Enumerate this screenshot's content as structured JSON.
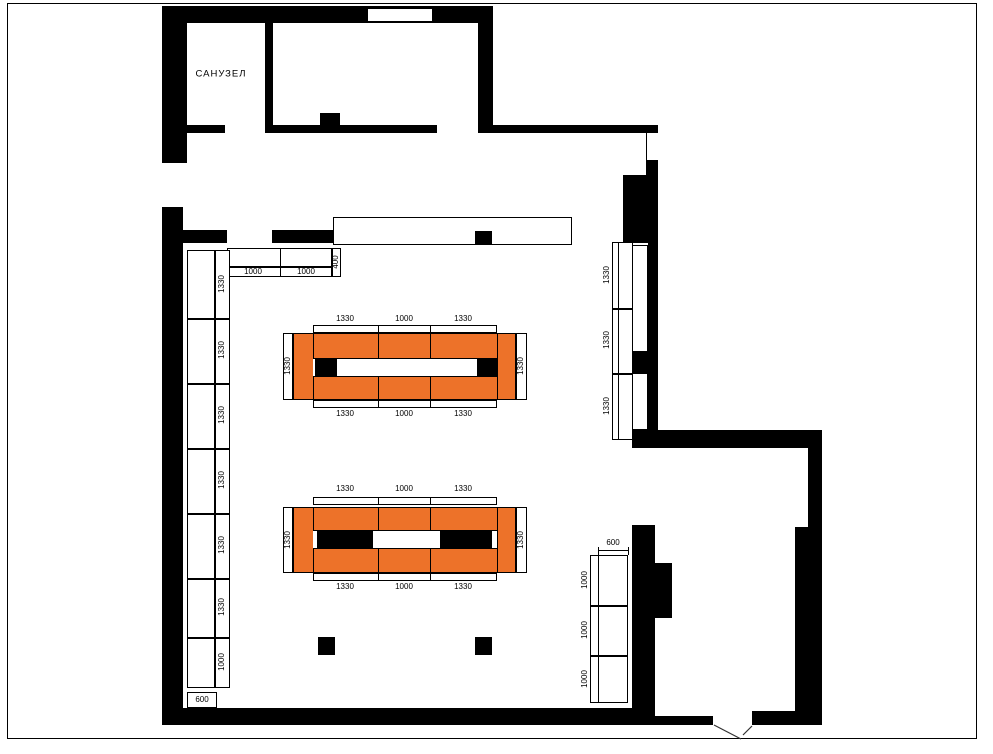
{
  "rooms": {
    "bathroom_label": "САНУЗЕЛ"
  },
  "colors": {
    "background": "#ffffff",
    "wall": "#000000",
    "gondola": "#ED7229",
    "dimension_text": "#000000"
  },
  "gondola_top": {
    "top_dims": [
      "1330",
      "1000",
      "1330"
    ],
    "bottom_dims": [
      "1330",
      "1000",
      "1330"
    ],
    "left_dim": "1330",
    "right_dim": "1330"
  },
  "gondola_bottom": {
    "top_dims": [
      "1330",
      "1000",
      "1330"
    ],
    "bottom_dims": [
      "1330",
      "1000",
      "1330"
    ],
    "left_dim": "1330",
    "right_dim": "1330"
  },
  "left_rack": {
    "segment_dims": [
      "1330",
      "1330",
      "1330",
      "1330",
      "1330",
      "1330",
      "1000"
    ],
    "depth_dim": "600"
  },
  "right_rack": {
    "segment_dims": [
      "1330",
      "1330",
      "1330"
    ]
  },
  "bottom_right_rack": {
    "segment_dims": [
      "1000",
      "1000",
      "1000"
    ],
    "depth_dim": "600"
  },
  "top_shelf": {
    "segment_dims": [
      "1000",
      "1000"
    ],
    "depth_dim": "400"
  }
}
